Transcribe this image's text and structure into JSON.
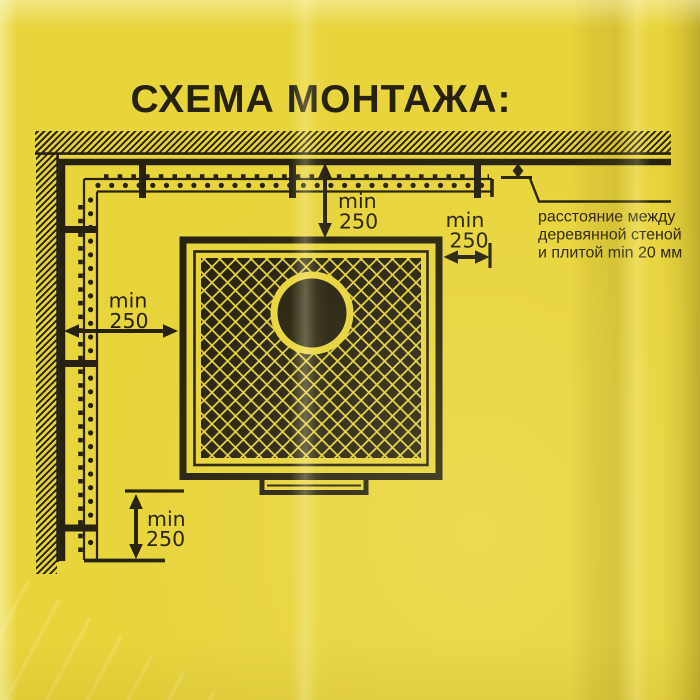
{
  "title": "СХЕМА МОНТАЖА:",
  "dimensions": {
    "top": {
      "label": "min",
      "value": "250"
    },
    "right": {
      "label": "min",
      "value": "250"
    },
    "left": {
      "label": "min",
      "value": "250"
    },
    "bottom": {
      "label": "min",
      "value": "250"
    }
  },
  "wall_gap_note": {
    "line1": "расстояние между",
    "line2": "деревянной стеной",
    "line3": "и плитой min 20 мм"
  },
  "colors": {
    "background": "#e8d43b",
    "ink": "#26220f"
  }
}
